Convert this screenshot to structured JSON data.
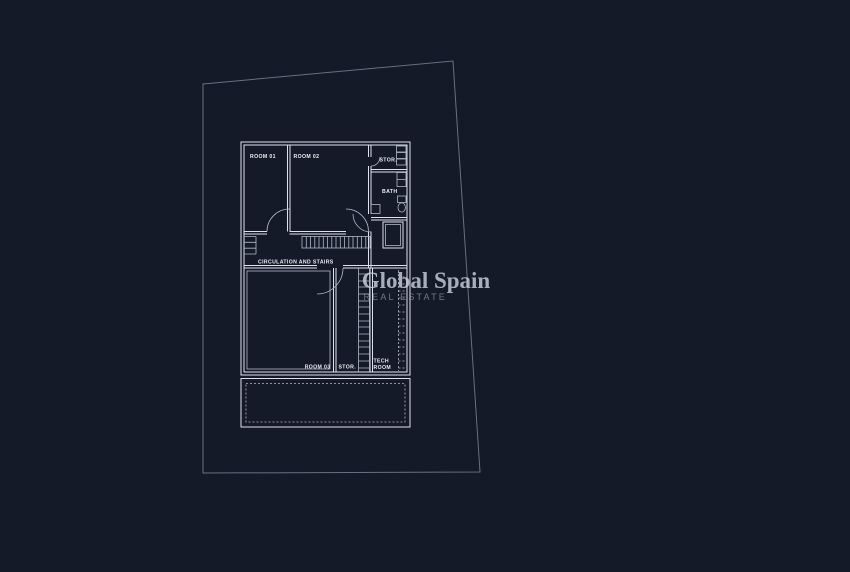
{
  "colors": {
    "background": "#151a28",
    "parcel_line": "#7c8699",
    "wall_line": "#dde3ed",
    "detail_line": "#aeb8c9",
    "label_text": "#e8edf4",
    "watermark_primary": "#c9d0dc",
    "watermark_secondary": "#aab3c2"
  },
  "watermark": {
    "brand": "Global Spain",
    "tagline": "REAL ESTATE"
  },
  "plan": {
    "labels": {
      "room01": "ROOM 01",
      "room02": "ROOM 02",
      "stor_upper": "STOR.",
      "bath": "BATH",
      "circulation": "CIRCULATION AND STAIRS",
      "room03": "ROOM 03",
      "stor_lower": "STOR.",
      "tech_room_lines": [
        "TECH",
        "ROOM"
      ]
    }
  }
}
